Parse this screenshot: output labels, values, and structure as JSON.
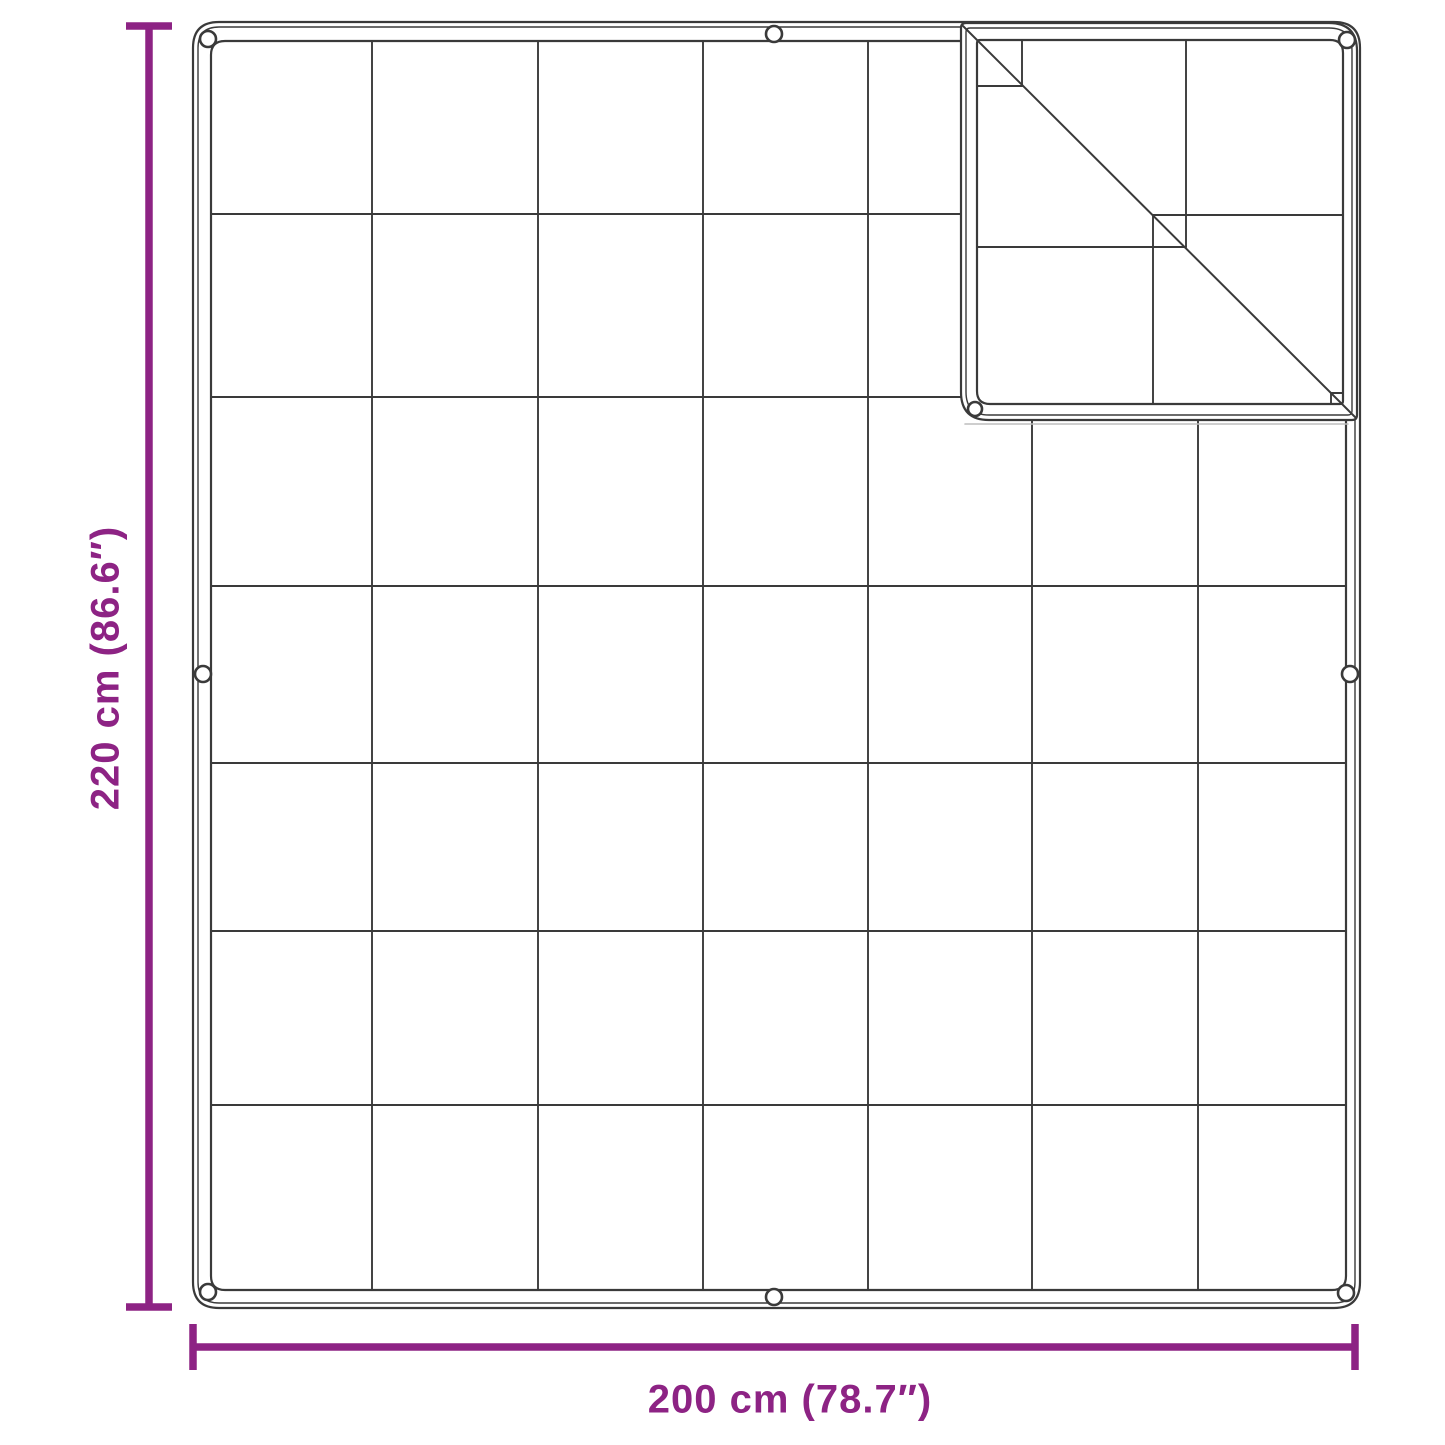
{
  "diagram": {
    "type": "product-dimension-diagram",
    "subject": "quilted blanket / tarp with grid stitching, corner fold and grommets",
    "vertical_dimension": {
      "label": "220 cm (86.6″)"
    },
    "horizontal_dimension": {
      "label": "200 cm (78.7″)"
    },
    "grid": {
      "columns": 7,
      "rows": 7
    },
    "icons": [
      "grommet-icon"
    ],
    "colors": {
      "dimension_accent": "#8d2384",
      "outline": "#3a3a3a",
      "background": "#ffffff"
    }
  }
}
